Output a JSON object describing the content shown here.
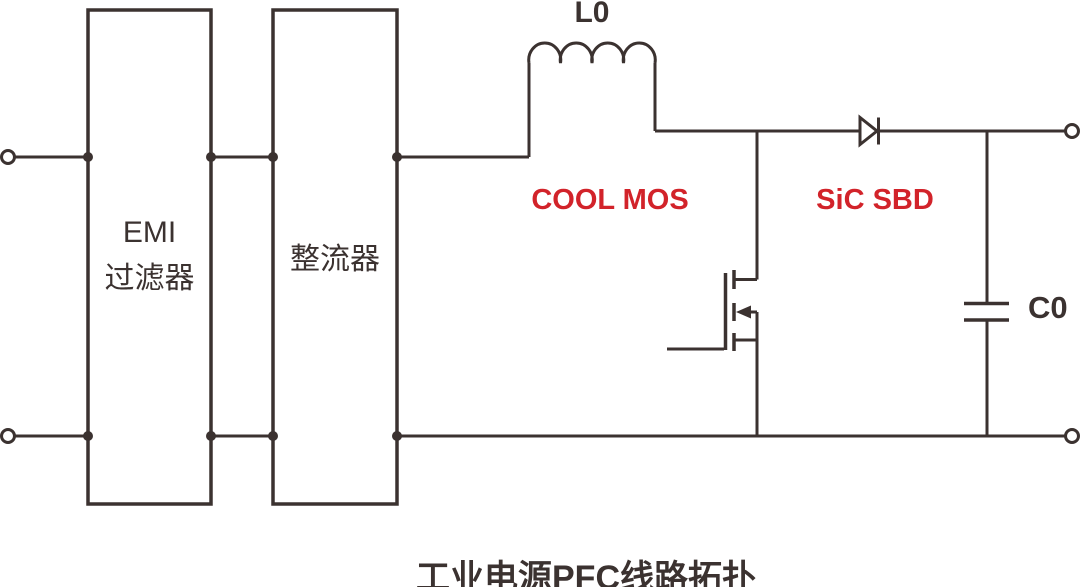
{
  "title": "工业电源PFC线路拓扑",
  "blocks": {
    "emi": {
      "line1": "EMI",
      "line2": "过滤器"
    },
    "rectifier": {
      "label": "整流器"
    }
  },
  "labels": {
    "inductor": "L0",
    "mosfet": "COOL MOS",
    "diode": "SiC SBD",
    "capacitor": "C0"
  },
  "colors": {
    "line": "#3B3230",
    "accent_red": "#D2232A",
    "background": "#FFFFFF"
  }
}
